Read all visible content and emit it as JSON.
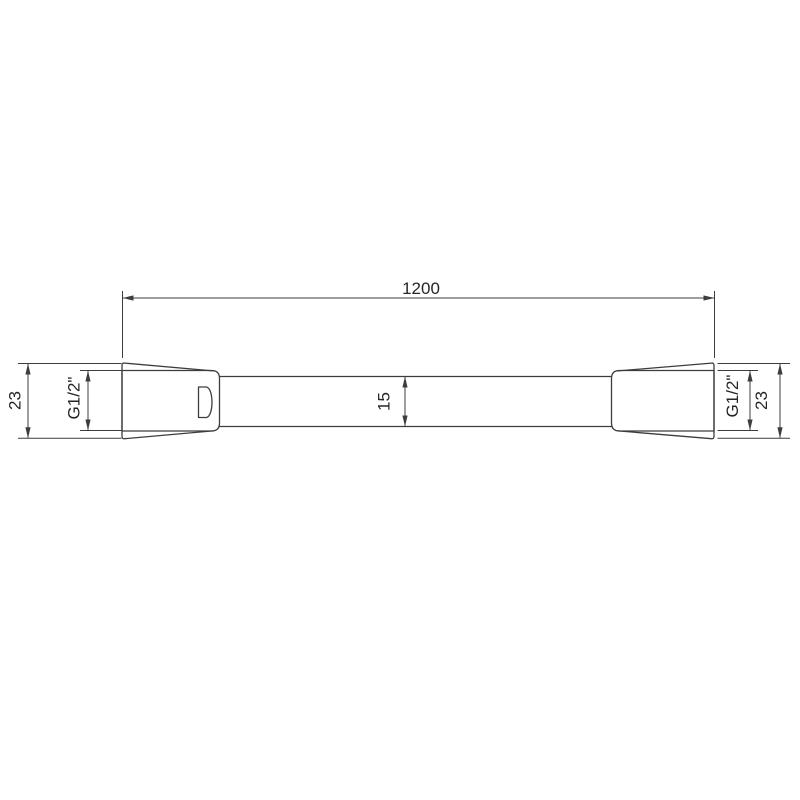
{
  "drawing": {
    "type": "technical-dimension-drawing",
    "labels": {
      "overall_length": "1200",
      "hose_diameter": "15",
      "left_nut_height": "23",
      "left_thread": "G1/2\"",
      "right_thread": "G1/2\"",
      "right_nut_height": "23"
    },
    "colors": {
      "background": "#ffffff",
      "line": "#3d3d3d",
      "text": "#262626"
    }
  }
}
